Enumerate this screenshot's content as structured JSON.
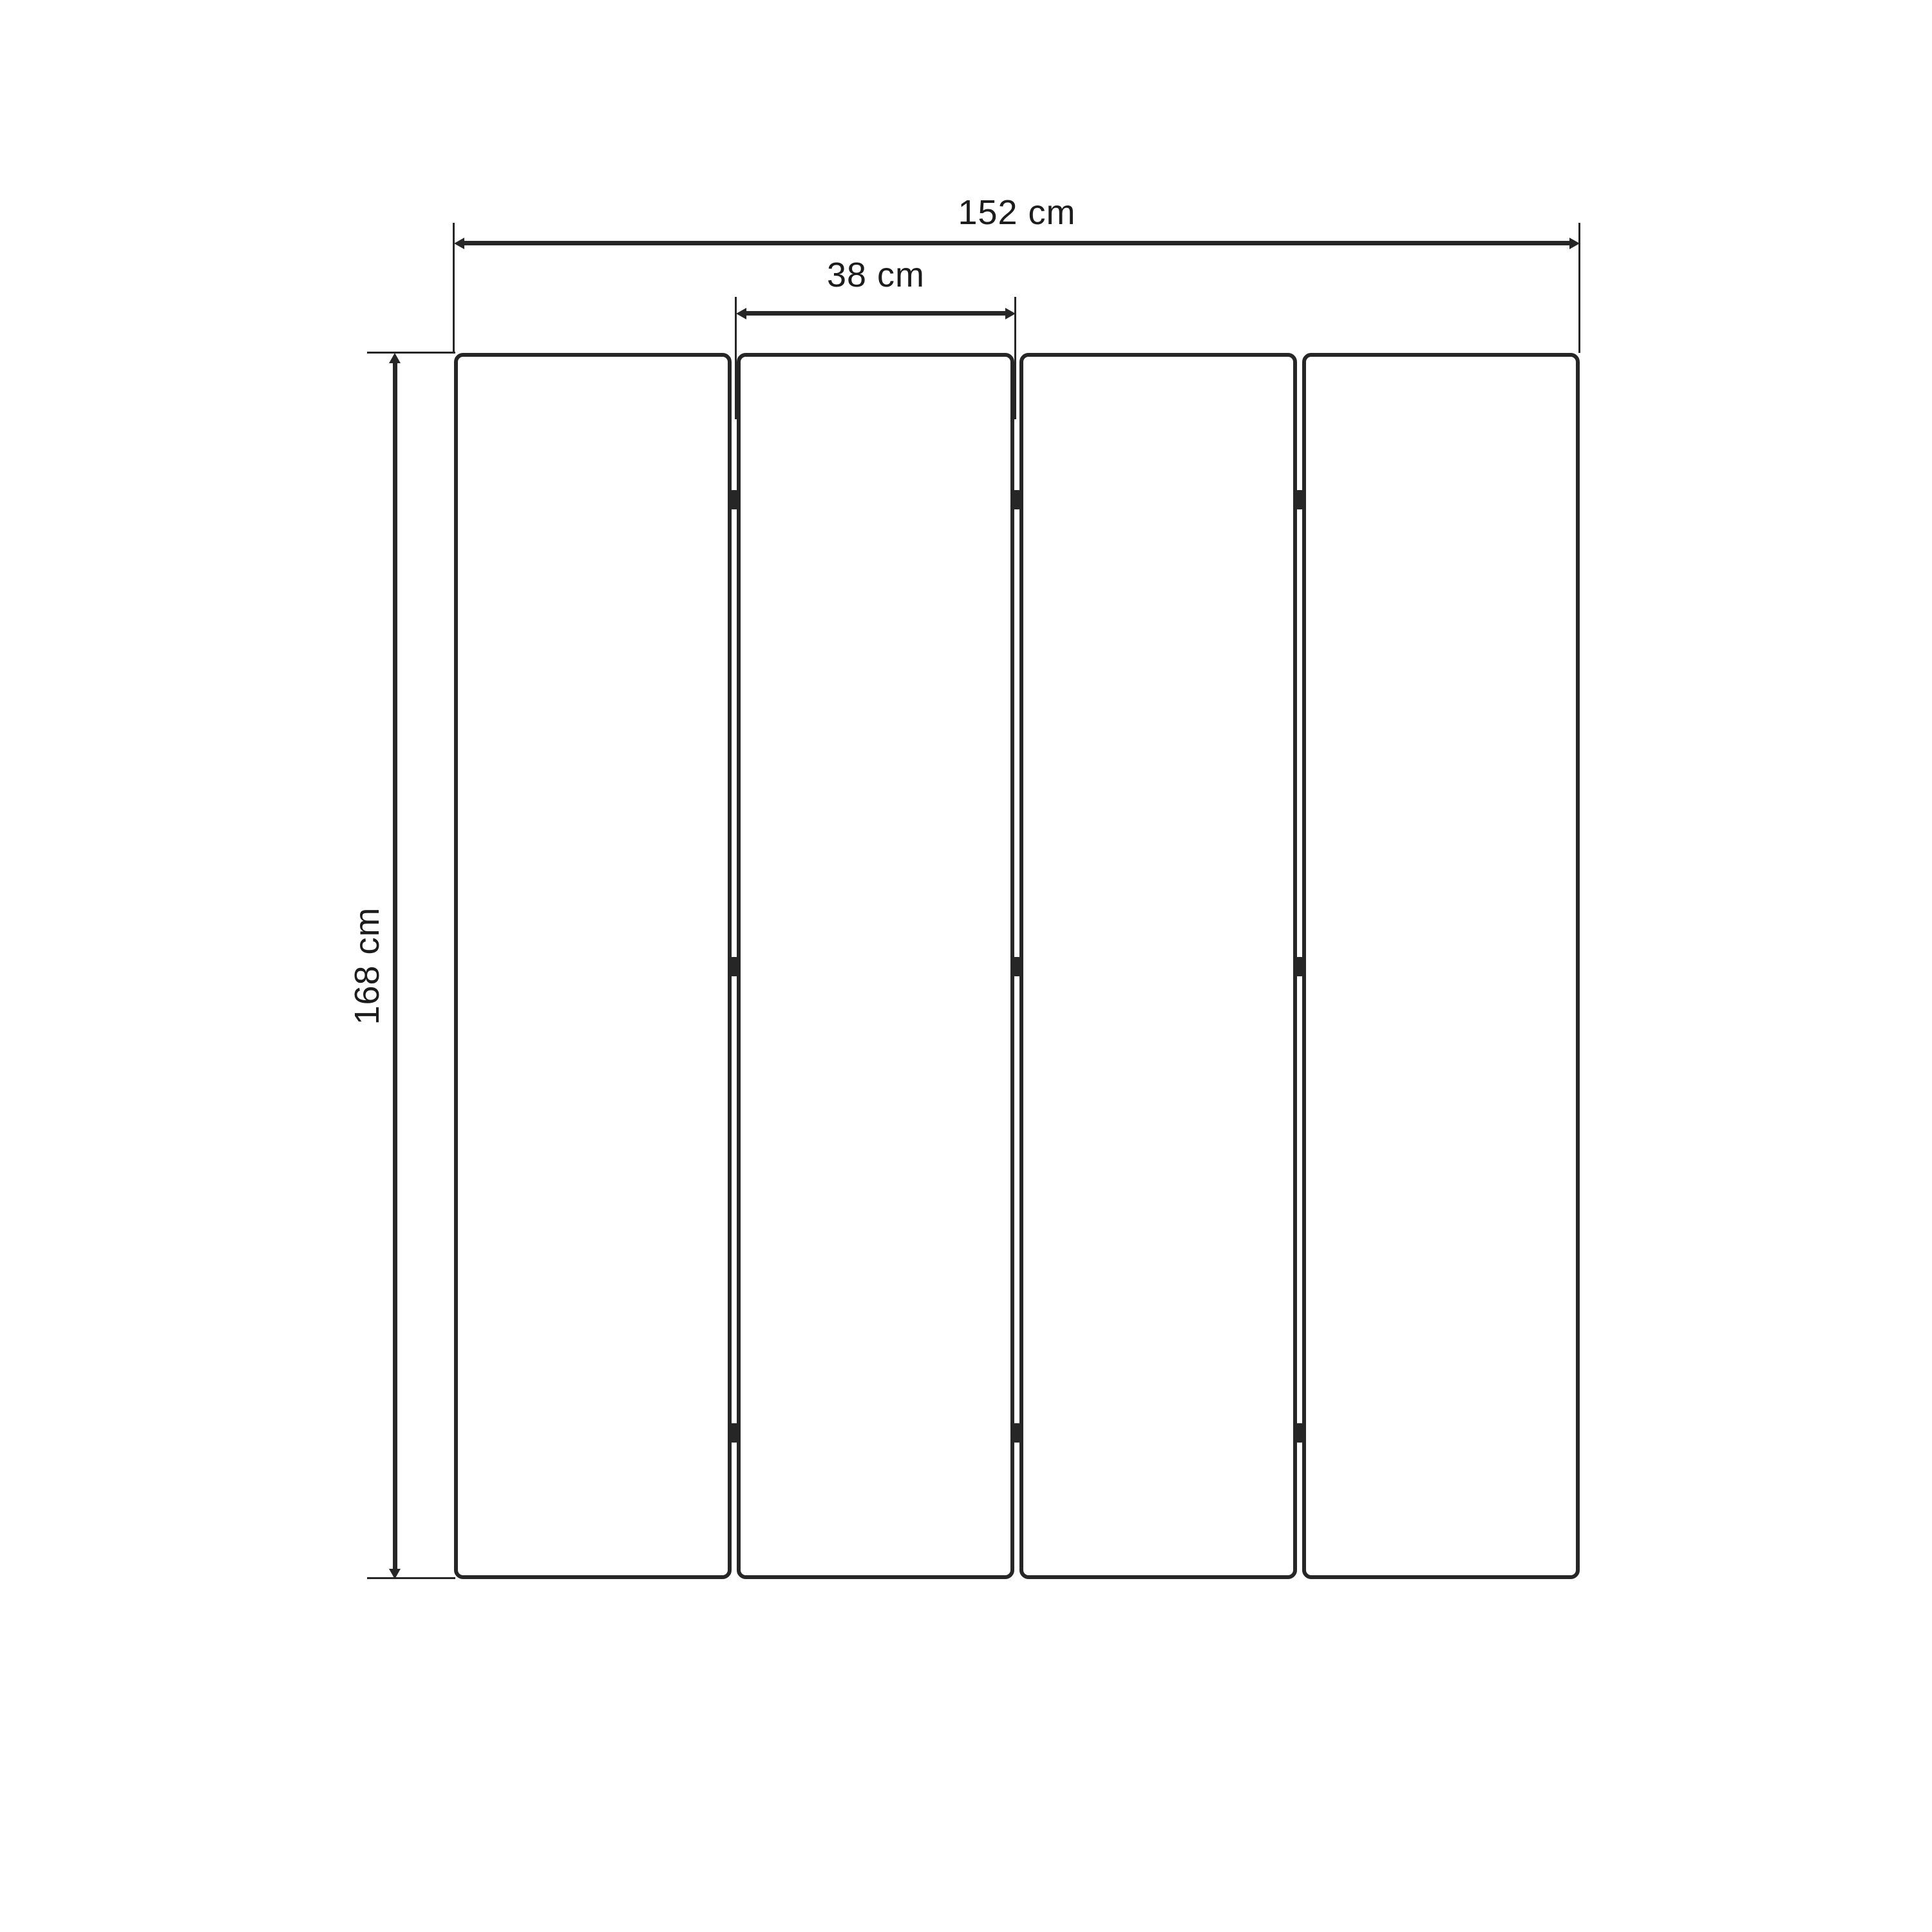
{
  "diagram": {
    "kind": "dimension-drawing",
    "panel_count": 4,
    "hinges_per_gap": 3
  },
  "dimensions": {
    "total_width": {
      "label": "152 cm",
      "value": 152,
      "unit": "cm"
    },
    "panel_width": {
      "label": "38 cm",
      "value": 38,
      "unit": "cm"
    },
    "height": {
      "label": "168 cm",
      "value": 168,
      "unit": "cm"
    }
  },
  "colors": {
    "line": "#262626",
    "text": "#1c1c1c",
    "background": "#ffffff"
  }
}
